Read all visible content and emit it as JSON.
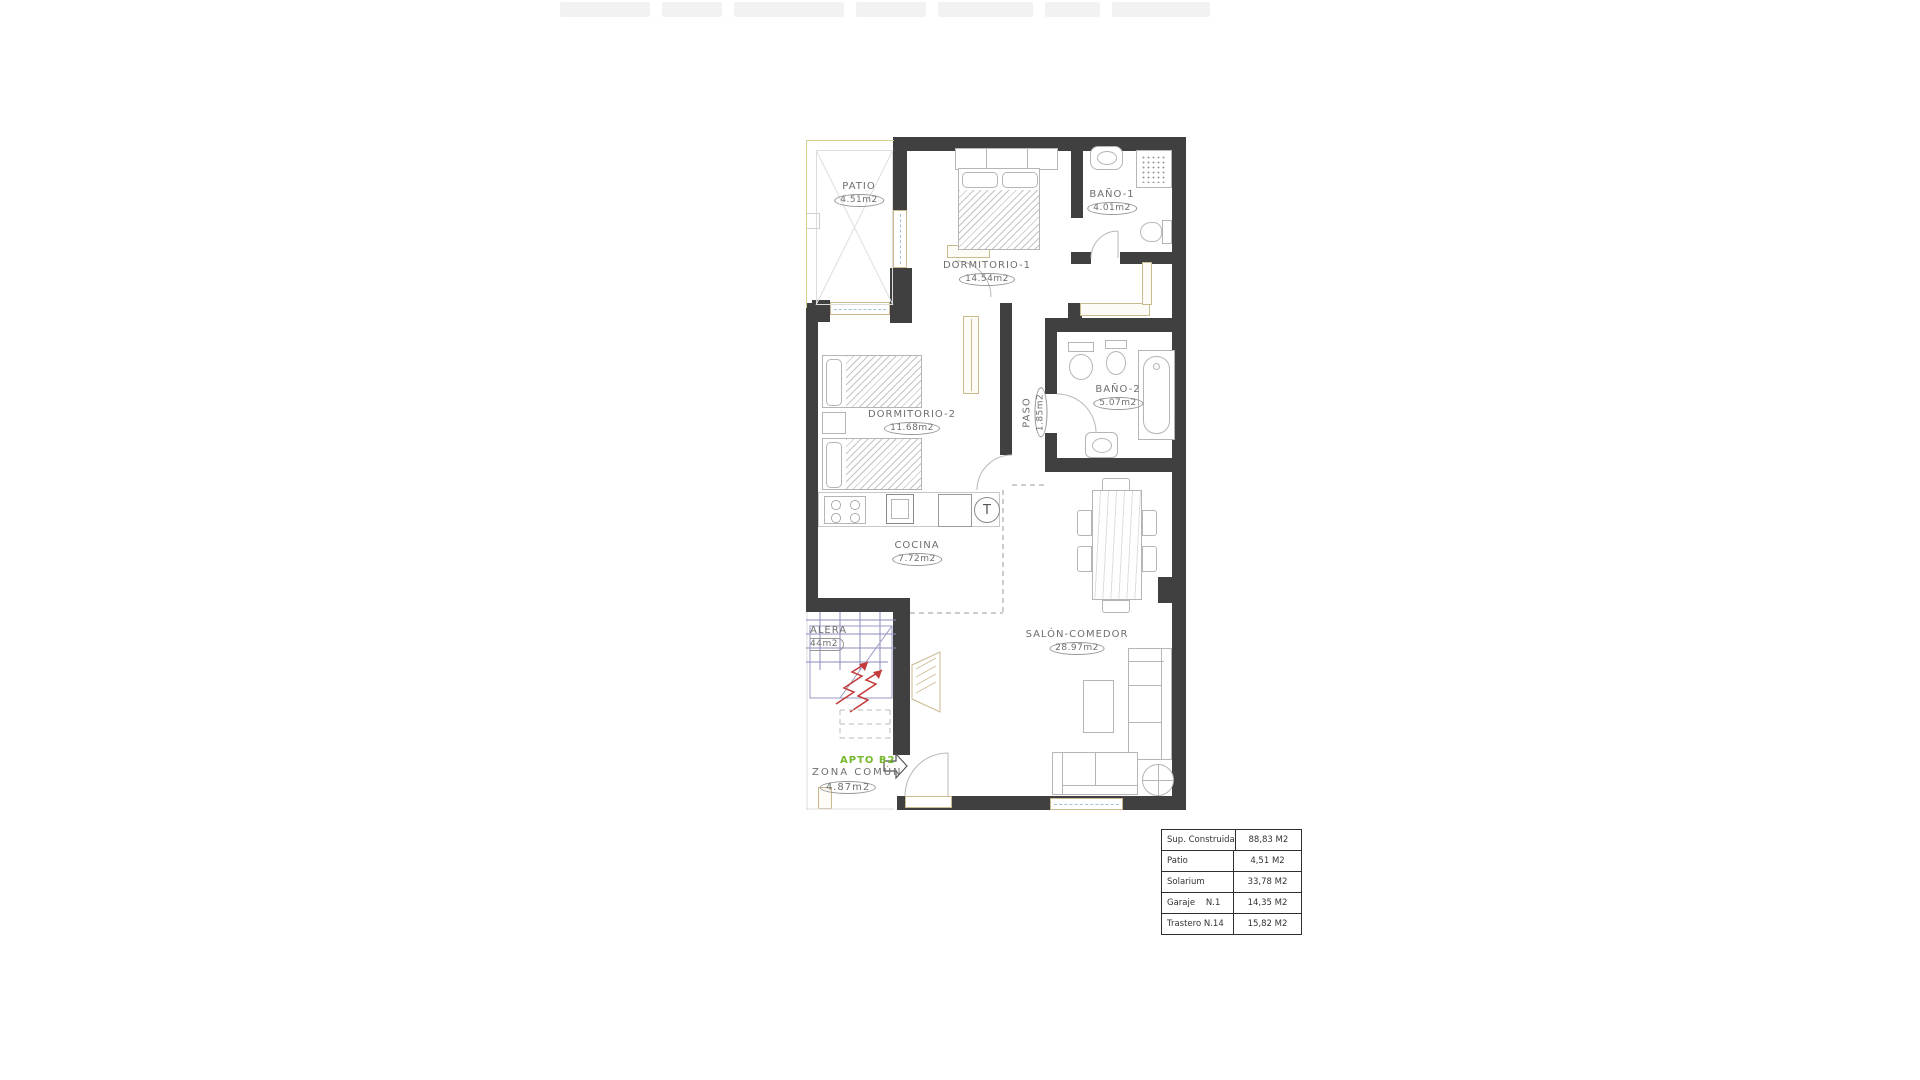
{
  "plan": {
    "apartment_label": "APTO B2",
    "boiler_symbol": "T",
    "rooms": [
      {
        "id": "patio",
        "name": "PATIO",
        "area": "4.51m2"
      },
      {
        "id": "dormitorio-1",
        "name": "DORMITORIO-1",
        "area": "14.54m2"
      },
      {
        "id": "bano-1",
        "name": "BAÑO-1",
        "area": "4.01m2"
      },
      {
        "id": "dormitorio-2",
        "name": "DORMITORIO-2",
        "area": "11.68m2"
      },
      {
        "id": "paso",
        "name": "PASO",
        "area": "1.85m2"
      },
      {
        "id": "bano-2",
        "name": "BAÑO-2",
        "area": "5.07m2"
      },
      {
        "id": "cocina",
        "name": "COCINA",
        "area": "7.72m2"
      },
      {
        "id": "salon-comedor",
        "name": "SALÓN-COMEDOR",
        "area": "28.97m2"
      },
      {
        "id": "escalera-truncated",
        "name": "ALERA",
        "area": "44m2"
      },
      {
        "id": "zona-comun",
        "name": "ZONA COMÚN",
        "area": "4.87m2"
      }
    ]
  },
  "summary_table": {
    "rows": [
      {
        "label": "Sup. Construida",
        "value": "88,83 M2"
      },
      {
        "label": "Patio",
        "value": "4,51 M2"
      },
      {
        "label": "Solarium",
        "value": "33,78 M2"
      },
      {
        "label": "Garaje    N.1",
        "value": "14,35 M2"
      },
      {
        "label": "Trastero N.14",
        "value": "15,82 M2"
      }
    ]
  },
  "colors": {
    "wall": "#404040",
    "tan": "#cbb98e",
    "blue": "#9fc6d6",
    "olive": "#d5d291",
    "green": "#76b82e",
    "red": "#c43b3b",
    "stairblue": "#8b8bbd",
    "labelgray": "#6e6e6e"
  }
}
